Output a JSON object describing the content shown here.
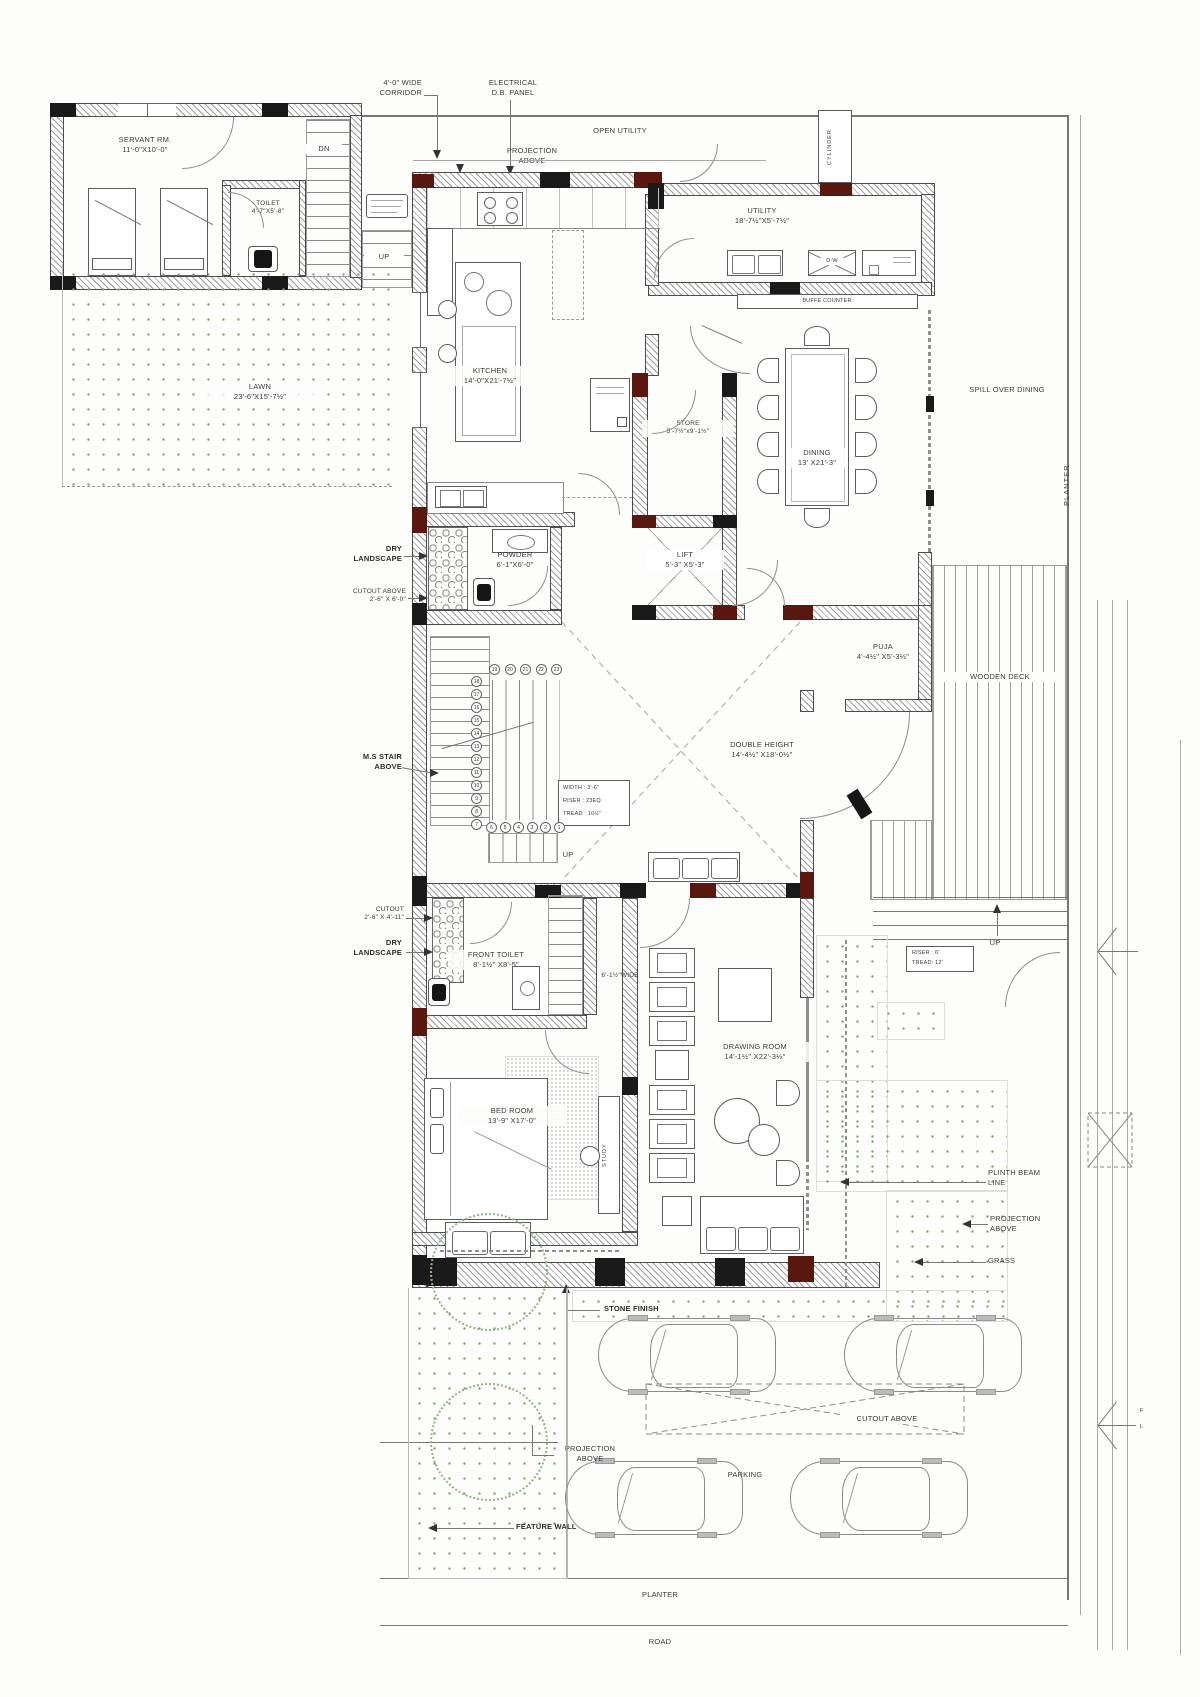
{
  "rooms": {
    "servant": {
      "name": "SERVANT RM.",
      "dims": "11'-0\"X10'-0\""
    },
    "toilet": {
      "name": "TOILET",
      "dims": "4'-7\"X5'-8\""
    },
    "lawn": {
      "name": "LAWN",
      "dims": "23'-6\"X15'-7½\""
    },
    "kitchen": {
      "name": "KITCHEN",
      "dims": "14'-0\"X21'-7½\""
    },
    "utility": {
      "name": "UTILITY",
      "dims": "18'-7½\"X5'-7½\""
    },
    "store": {
      "name": "STORE",
      "dims": "5'-7½\"x9'-1½\""
    },
    "dining": {
      "name": "DINING",
      "dims": "13' X21'-3\""
    },
    "powder": {
      "name": "POWDER",
      "dims": "6'-1\"X6'-0\""
    },
    "lift": {
      "name": "LIFT",
      "dims": "5'-3\" X5'-3\""
    },
    "puja": {
      "name": "PUJA",
      "dims": "4'-4½\" X5'-3½\""
    },
    "double_height": {
      "name": "DOUBLE HEIGHT",
      "dims": "14'-4½\" X18'-0½\""
    },
    "front_toilet": {
      "name": "FRONT TOILET",
      "dims": "8'-1½\" X8'-5\""
    },
    "bed": {
      "name": "BED ROOM",
      "dims": "13'-9\" X17'-0\""
    },
    "drawing": {
      "name": "DRAWING ROOM",
      "dims": "14'-1½\" X22'-3½\""
    }
  },
  "areas": {
    "open_utility": "OPEN UTILITY",
    "cylinder": "CYLINDER",
    "spill": "SPILL OVER DINING",
    "planter_right": "PLANTER",
    "deck": "WOODEN DECK",
    "study": "STUDY",
    "grass": "GRASS",
    "parking": "PARKING",
    "planter_bottom": "PLANTER",
    "road": "ROAD"
  },
  "annotations": {
    "corridor_l1": "4'-0\" WIDE",
    "corridor_l2": "CORRIDOR",
    "electrical_l1": "ELECTRICAL",
    "electrical_l2": "D.B. PANEL",
    "projection_l1": "PROJECTION",
    "projection_l2": "ABOVE",
    "buffet": "BUFFE COUNTER",
    "dw": "D-W",
    "dry_l1": "DRY",
    "dry_l2": "LANDSCAPE",
    "cutout_above_l1": "CUTOUT ABOVE",
    "cutout_above_dims": "2'-6\" X 6'-0\"",
    "cutout_l1": "CUTOUT",
    "cutout_dims": "2'-6\" X 4'-11\"",
    "ms_stair_l1": "M.S STAIR",
    "ms_stair_l2": "ABOVE",
    "wide_passage": "6'-1½\"WIDE",
    "plinth_l1": "PLINTH BEAM",
    "plinth_l2": "LINE",
    "stone_finish": "STONE FINISH",
    "cutout_parking": "CUTOUT ABOVE",
    "feature_wall": "FEATURE WALL",
    "up": "UP",
    "dn": "DN",
    "fl_l1": "F",
    "fl_l2": "L"
  },
  "stair_main": {
    "box": [
      "WIDTH : 3'-6\"",
      "RISER : 23EQ.",
      "TREAD : 10½\""
    ],
    "top_row": [
      "19",
      "20",
      "21",
      "22",
      "23"
    ],
    "column": [
      "18",
      "17",
      "16",
      "15",
      "14",
      "13",
      "12",
      "11",
      "10",
      "9",
      "8",
      "7"
    ],
    "bottom_row": [
      "6",
      "5",
      "4",
      "3",
      "2",
      "1"
    ]
  },
  "stair_entry": {
    "box": [
      "RISER : 6'",
      "TREAD: 12'"
    ]
  },
  "colors": {
    "column_dark": "#1a1a1a",
    "column_red": "#5a170f",
    "grass_dot": "#7fa470",
    "hatch": "#9b9b9b"
  }
}
